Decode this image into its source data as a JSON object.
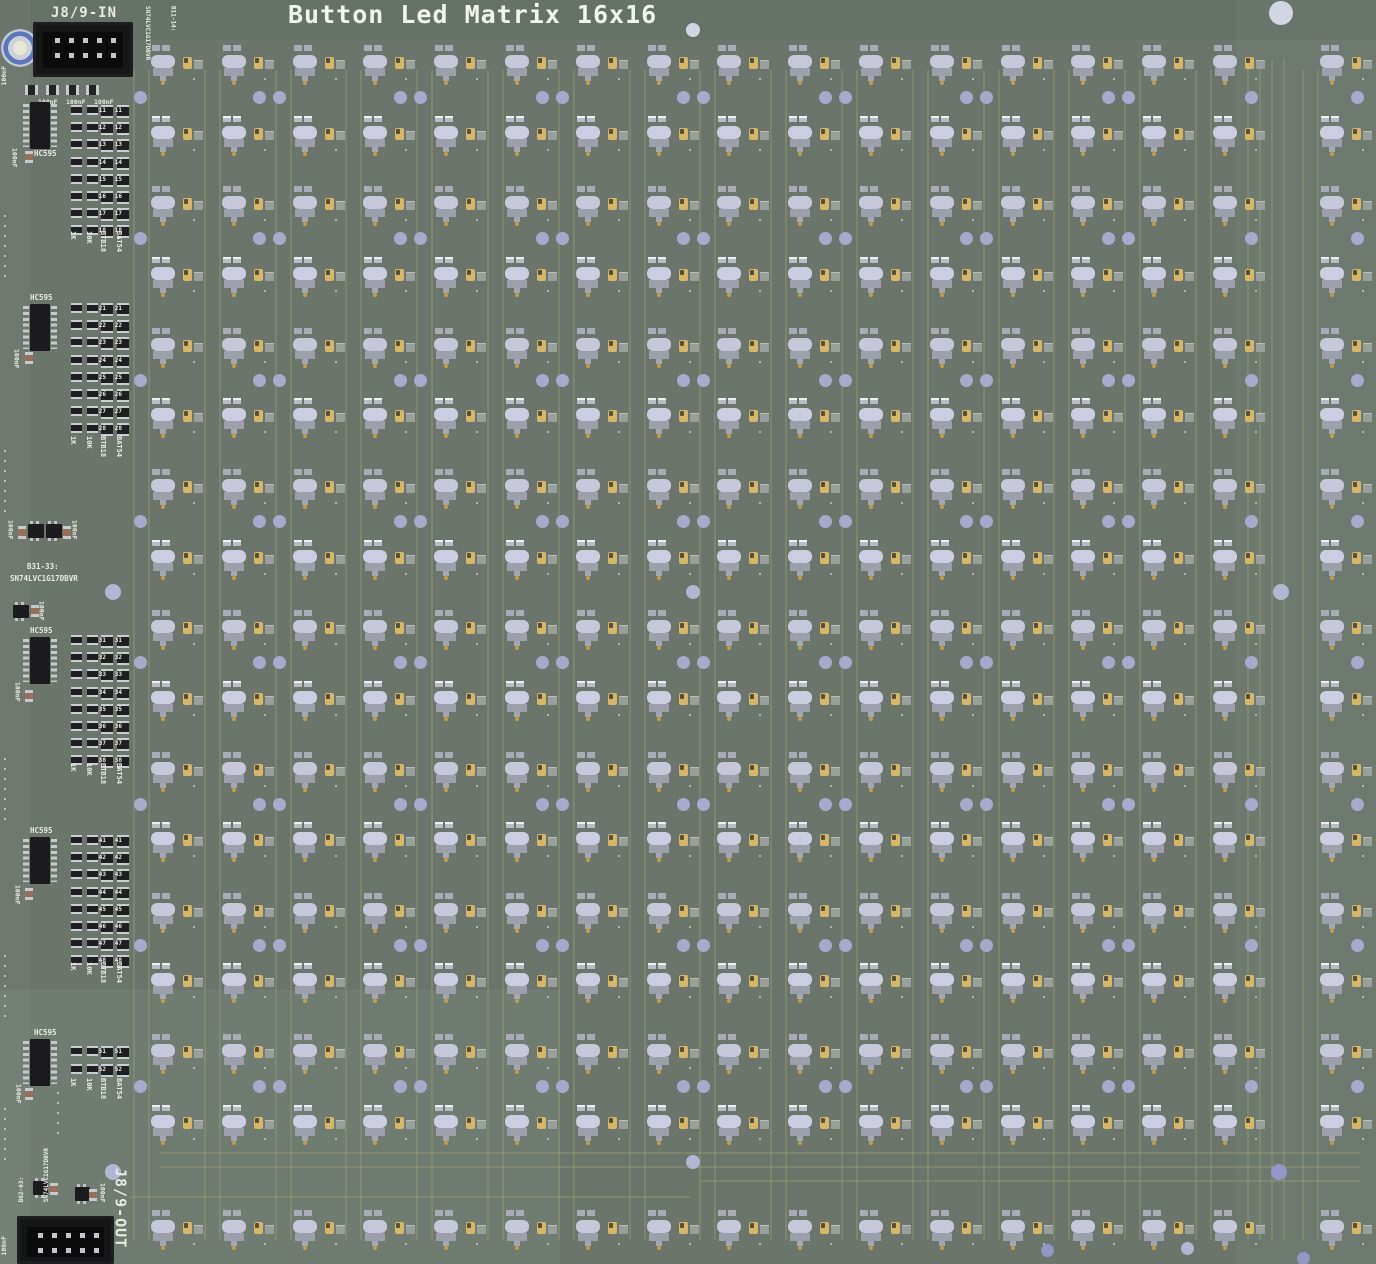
{
  "header": {
    "title": "Button Led Matrix 16x16"
  },
  "silkscreen": {
    "connector_in": "J8/9-IN",
    "connector_out": "J8/9-OUT",
    "note_in_ref": "B11-14:",
    "note_in_part": "SN74LVC1G17DBVR",
    "note_mid_ref": "B31-33:",
    "note_mid_part": "SN74LVC1G17DBVR",
    "note_out_ref": "B62-63:",
    "note_out_part": "SN74LVC1G17DBVR",
    "cap_value": "100nF",
    "top_cap_labels": [
      "100nF",
      "100nF",
      "100nF"
    ]
  },
  "ic_blocks": [
    {
      "label": "HC595",
      "col_labels": [
        "1K",
        "10K",
        "BTB18",
        "BAT54"
      ],
      "designators": [
        "11",
        "12",
        "13",
        "14",
        "15",
        "16",
        "17",
        "18"
      ]
    },
    {
      "label": "HC595",
      "col_labels": [
        "1K",
        "10K",
        "BTB18",
        "BAT54"
      ],
      "designators": [
        "21",
        "22",
        "23",
        "24",
        "25",
        "26",
        "27",
        "28"
      ]
    },
    {
      "label": "HC595",
      "col_labels": [
        "1K",
        "10K",
        "BTB18",
        "BAT54"
      ],
      "designators": [
        "31",
        "32",
        "33",
        "34",
        "35",
        "36",
        "37",
        "38"
      ]
    },
    {
      "label": "HC595",
      "col_labels": [
        "1K",
        "10K",
        "BTB18",
        "BAT54"
      ],
      "designators": [
        "41",
        "42",
        "43",
        "44",
        "45",
        "46",
        "47",
        "48"
      ]
    },
    {
      "label": "HC595",
      "col_labels": [
        "1K",
        "10K",
        "BTB18",
        "BAT54"
      ],
      "designators": [
        "51",
        "52"
      ]
    }
  ],
  "matrix": {
    "rows": 16,
    "cols": 16,
    "description": "16x16 grid of tactile buttons with LEDs"
  },
  "colors": {
    "board": "#6b756b",
    "silkscreen": "#e9ebe1",
    "button_body": "#c6c7d8",
    "button_pad": "#a9abb6",
    "hole": "#b3b5d2",
    "gold_pad": "#c59f48",
    "led_body": "#d5b768",
    "diode_body": "#99a09b",
    "trace": "#8a8e70",
    "ic_body": "#1b1b1d",
    "pin_silver": "#c3c7cb"
  }
}
